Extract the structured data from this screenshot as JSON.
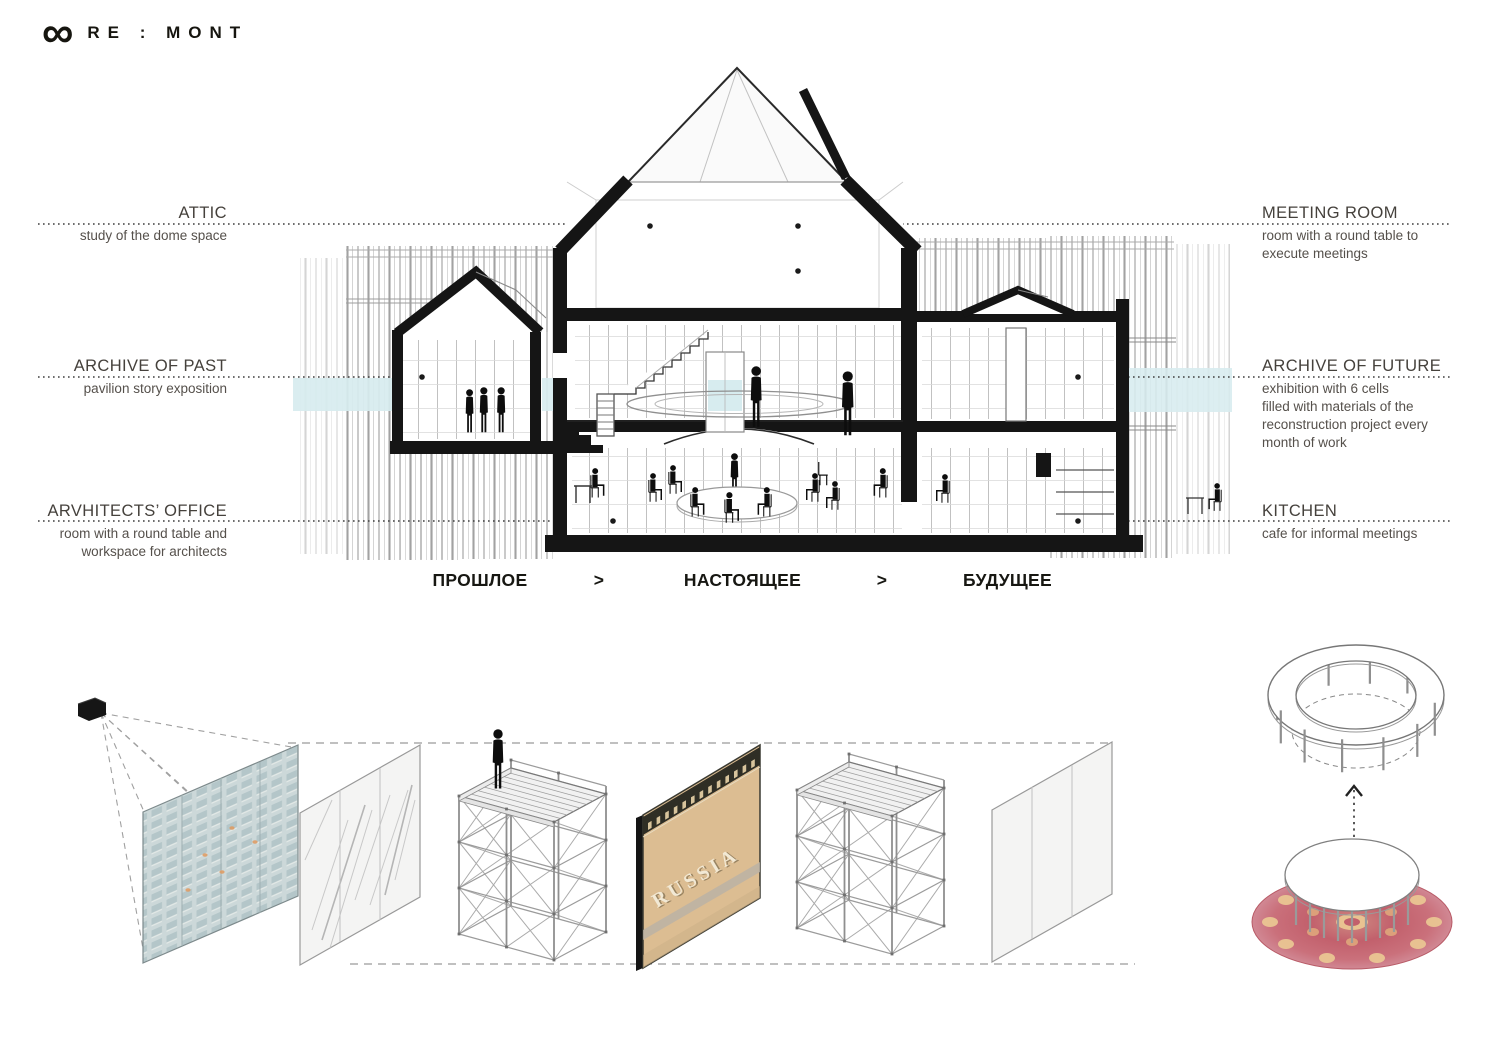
{
  "logo": {
    "symbol": "∞",
    "name": "RE : MONT"
  },
  "labels": {
    "attic": {
      "title": "ATTIC",
      "desc": [
        "study of the dome space"
      ]
    },
    "meeting_room": {
      "title": "MEETING ROOM",
      "desc": [
        "room with a round table  to",
        "execute meetings"
      ]
    },
    "archive_of_past": {
      "title": "ARCHIVE OF PAST",
      "desc": [
        "pavilion story exposition"
      ]
    },
    "archive_of_future": {
      "title": "ARCHIVE OF FUTURE",
      "desc": [
        "exhibition with 6 cells",
        "filled with materials of the",
        "reconstruction project every",
        "month of work"
      ]
    },
    "architects_office": {
      "title": "ARVHITECTS’ OFFICE",
      "desc": [
        "room with a round table and",
        "workspace for architects"
      ]
    },
    "kitchen": {
      "title": "KITCHEN",
      "desc": [
        "cafe for informal meetings"
      ]
    }
  },
  "timeline": {
    "past": "ПРОШЛОЕ",
    "arrow1": ">",
    "present": "НАСТОЯЩЕЕ",
    "arrow2": ">",
    "future": "БУДУЩЕЕ"
  },
  "russia_panel": {
    "label": "RUSSIA"
  },
  "palette": {
    "poche_black": "#151515",
    "accent_blue": "#d7ecef",
    "panel_tan": "#dcbd92",
    "carpet_red": "#c2606c",
    "curtain_gray": "#c0c0c0",
    "text_dark": "#45413c"
  }
}
